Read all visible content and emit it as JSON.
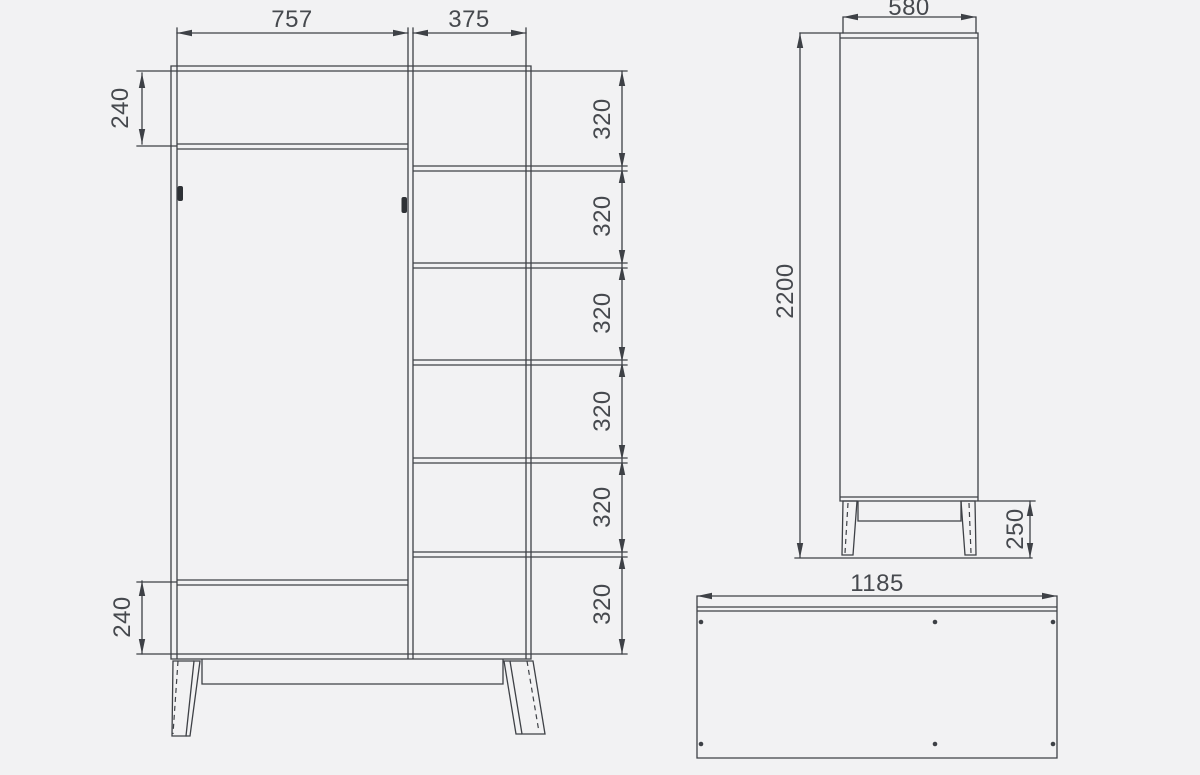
{
  "colors": {
    "line-color": "#3e4146",
    "text-color": "#46494e",
    "background-color": "#f2f2f3",
    "handle-color": "#2e3135"
  },
  "front_view": {
    "width_left": "757",
    "width_right": "375",
    "top_panel_height": "240",
    "bottom_panel_height": "240",
    "shelf_spacings": [
      "320",
      "320",
      "320",
      "320",
      "320",
      "320"
    ]
  },
  "side_view": {
    "depth": "580",
    "height": "2200",
    "leg_height": "250"
  },
  "bottom_view": {
    "width": "1185"
  }
}
